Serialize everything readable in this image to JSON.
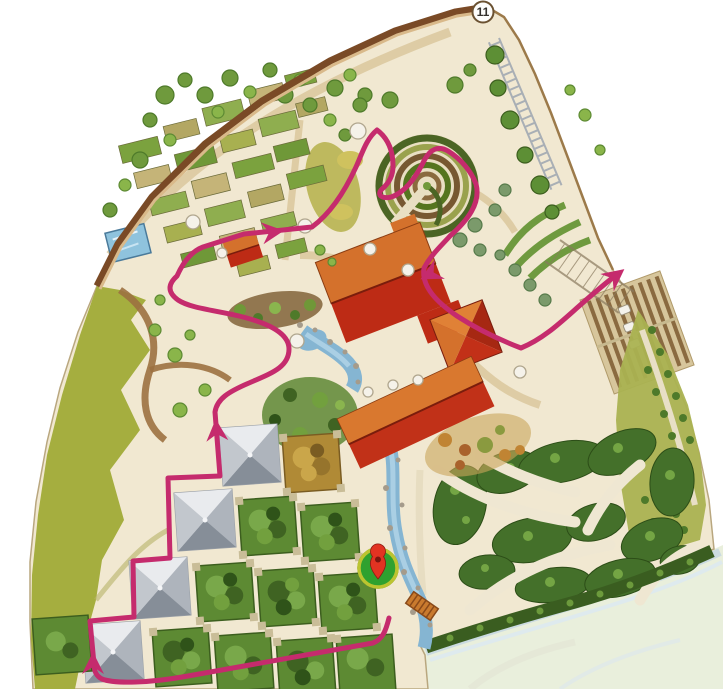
{
  "map": {
    "badge": {
      "label": "11",
      "transform": "translate(483,12)"
    },
    "marker": {
      "transform": "translate(378,568)",
      "body_color": "#2fa12f",
      "ring_color": "#bcc430",
      "pin_color": "#e23322",
      "hole_color": "#7c150f"
    },
    "route": {
      "color": "#c52b6d",
      "stroke_width": 5,
      "path_d": "M 389 618 C 386 630 383 639 373 643 L 188 676 C 150 683 115 684 102 679 C 96 676 94 671 94 664 L 90 621 L 134 617 L 133 561 L 170 558 L 168 478 L 220 476 L 215 412 C 217 399 228 392 249 383 C 272 373 289 367 289 349 C 289 333 268 323 239 316 C 213 310 190 308 178 300 C 167 292 168 284 177 276 C 185 258 195 250 203 247 L 244 234 L 312 227 C 331 213 345 191 356 167 C 362 154 366 139 377 130 C 389 139 393 152 393 166 C 393 177 388 184 382 189 C 375 196 385 201 396 195 C 409 188 418 173 425 159 C 430 150 438 145 448 151 C 461 159 471 171 476 184 C 481 203 468 220 450 236 C 441 246 431 255 424 268 C 421 287 438 303 457 316 C 477 329 500 340 521 348 C 543 339 560 323 578 307 C 596 291 606 283 616 275",
      "arrows": [
        {
          "transform": "translate(93,655) rotate(-90)"
        },
        {
          "transform": "translate(216,422) rotate(-94)"
        },
        {
          "transform": "translate(281,231) rotate(-7)"
        },
        {
          "transform": "translate(423,278) rotate(152)"
        },
        {
          "transform": "translate(622,271) rotate(-38)"
        }
      ]
    },
    "colors": {
      "canvas": "#f1e8d1",
      "outside": "#ffffff",
      "river_bank": "#e9efdc",
      "water": "#85b5d2",
      "wall": "#7a4a26",
      "wall_inner": "#d9b98a",
      "meadow": "#a5ae3f",
      "hedge_dark": "#3f6322",
      "hedge_mid": "#5d8a33",
      "roof_orange": "#d4712c",
      "roof_red": "#bd2b15",
      "pyramid_grey": "#d2d5d9",
      "bed_tan": "#c3ab6b"
    }
  }
}
